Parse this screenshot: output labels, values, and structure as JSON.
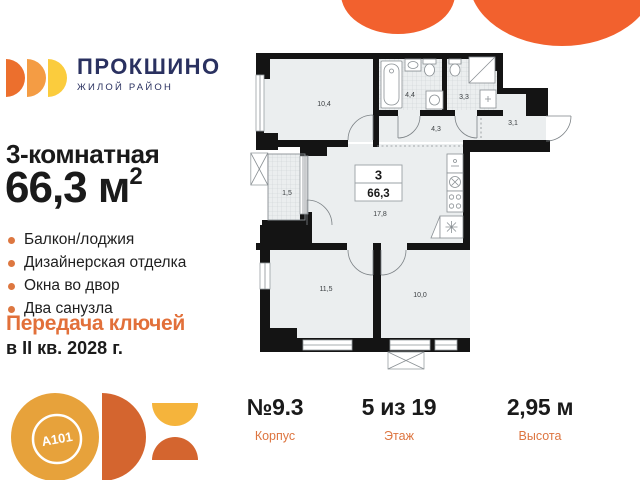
{
  "brand": {
    "name": "ПРОКШИНО",
    "tagline": "ЖИЛОЙ РАЙОН"
  },
  "listing": {
    "title": "3-комнатная",
    "area": "66,3 м",
    "area_sup": "2",
    "features": [
      "Балкон/лоджия",
      "Дизайнерская отделка",
      "Окна во двор",
      "Два санузла"
    ],
    "handover_label": "Передача ключей",
    "handover_term": "в II кв. 2028 г."
  },
  "floorplan": {
    "flat_type": "3",
    "flat_area": "66,3",
    "areas": {
      "room1": "10,4",
      "bath1": "4,4",
      "bath2": "3,3",
      "hall": "4,3",
      "entry": "3,1",
      "balcony": "1,5",
      "living": "17,8",
      "room2": "11,5",
      "room3": "10,0"
    }
  },
  "stats": [
    {
      "value": "№9.3",
      "label": "Корпус"
    },
    {
      "value": "5 из 19",
      "label": "Этаж"
    },
    {
      "value": "2,95 м",
      "label": "Высота"
    }
  ],
  "developer_logo": "A101",
  "colors": {
    "accent_orange": "#F2612E",
    "navy": "#2A3160",
    "muted_orange": "#DD7540",
    "logo_orange": "#EC6F2D",
    "logo_mid_orange": "#F49C44",
    "logo_yellow": "#FBCC3D",
    "a101_circle": "#E7A23B",
    "a101_dark_orange": "#D4652F",
    "plan_floor": "#EBEEEF",
    "wall": "#141414"
  }
}
